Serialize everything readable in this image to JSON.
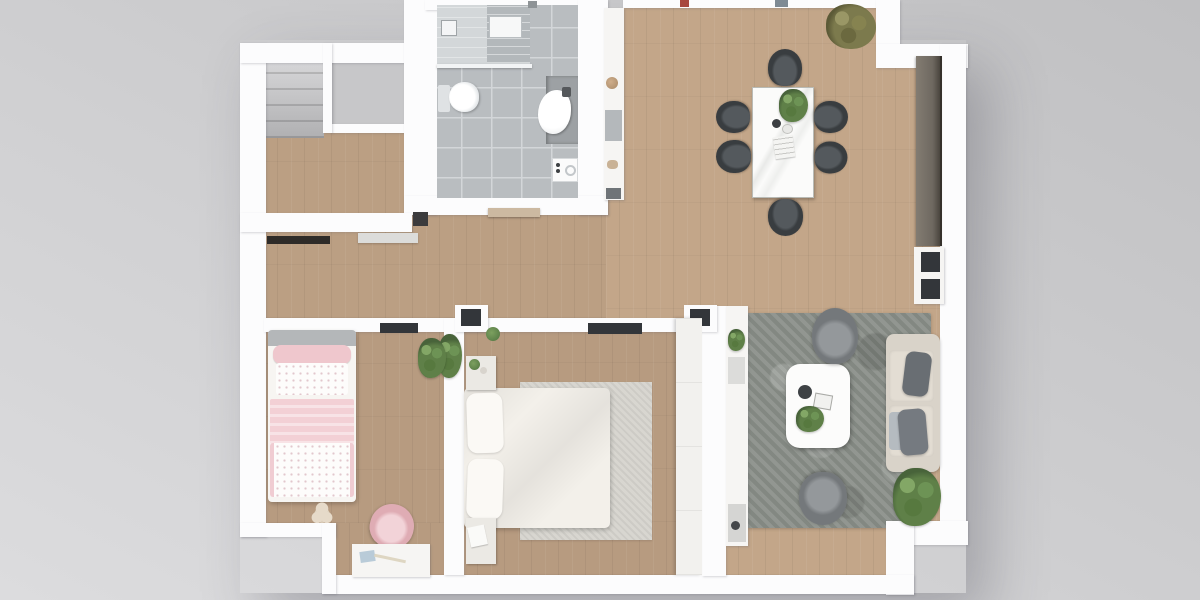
{
  "scene": {
    "type": "floor-plan-3d-top-view",
    "description": "Top-down 3D architectural rendering of a two-bedroom apartment on a gray backdrop",
    "rooms": [
      {
        "name": "entry-hall",
        "furniture": [
          "staircase",
          "closet-unit",
          "console-table",
          "bench"
        ]
      },
      {
        "name": "bathroom",
        "furniture": [
          "walk-in-shower",
          "toilet",
          "sink-vanity",
          "washing-machine"
        ]
      },
      {
        "name": "kitchenette-niche",
        "furniture": [
          "counter-shelf"
        ]
      },
      {
        "name": "living-dining-room",
        "furniture": [
          "dining-table",
          "dining-chairs-x6",
          "potted-plant",
          "sideboard",
          "window-unit",
          "area-rug",
          "coffee-table",
          "armchair-x2",
          "sofa",
          "media-unit",
          "floor-plant"
        ]
      },
      {
        "name": "kids-bedroom",
        "furniture": [
          "single-bed",
          "teddy-bear",
          "desk",
          "desk-chair",
          "potted-plant",
          "wall-shelf"
        ]
      },
      {
        "name": "master-bedroom",
        "furniture": [
          "double-bed",
          "bedside-rug",
          "nightstand-x2",
          "wardrobe",
          "wall-tv",
          "potted-plant"
        ]
      }
    ]
  },
  "colors": {
    "background_top": "#c0c0c2",
    "background_bottom": "#dcdcde",
    "wall": "#fcfcfd",
    "wood_living": "#c3a689",
    "wood_bedroom": "#b79b80",
    "wood_hall": "#bb9f83",
    "tile": "#b9bdc0",
    "tile_grout": "#d3d6d9",
    "rug_living": "#8b908a",
    "rug_master": "#d8d6d0",
    "counter_dark": "#6e6860",
    "chair": "#393d40",
    "sofa": "#d9d3c9",
    "sofa_pillow": "#696e73",
    "armchair": "#74787b",
    "pink": "#efc7cd",
    "plant": "#5f8048",
    "plant_olive": "#7c7a4d",
    "white_furniture": "#f6f5f3",
    "dark_accent": "#33363a",
    "teddy": "#e6dac9"
  }
}
